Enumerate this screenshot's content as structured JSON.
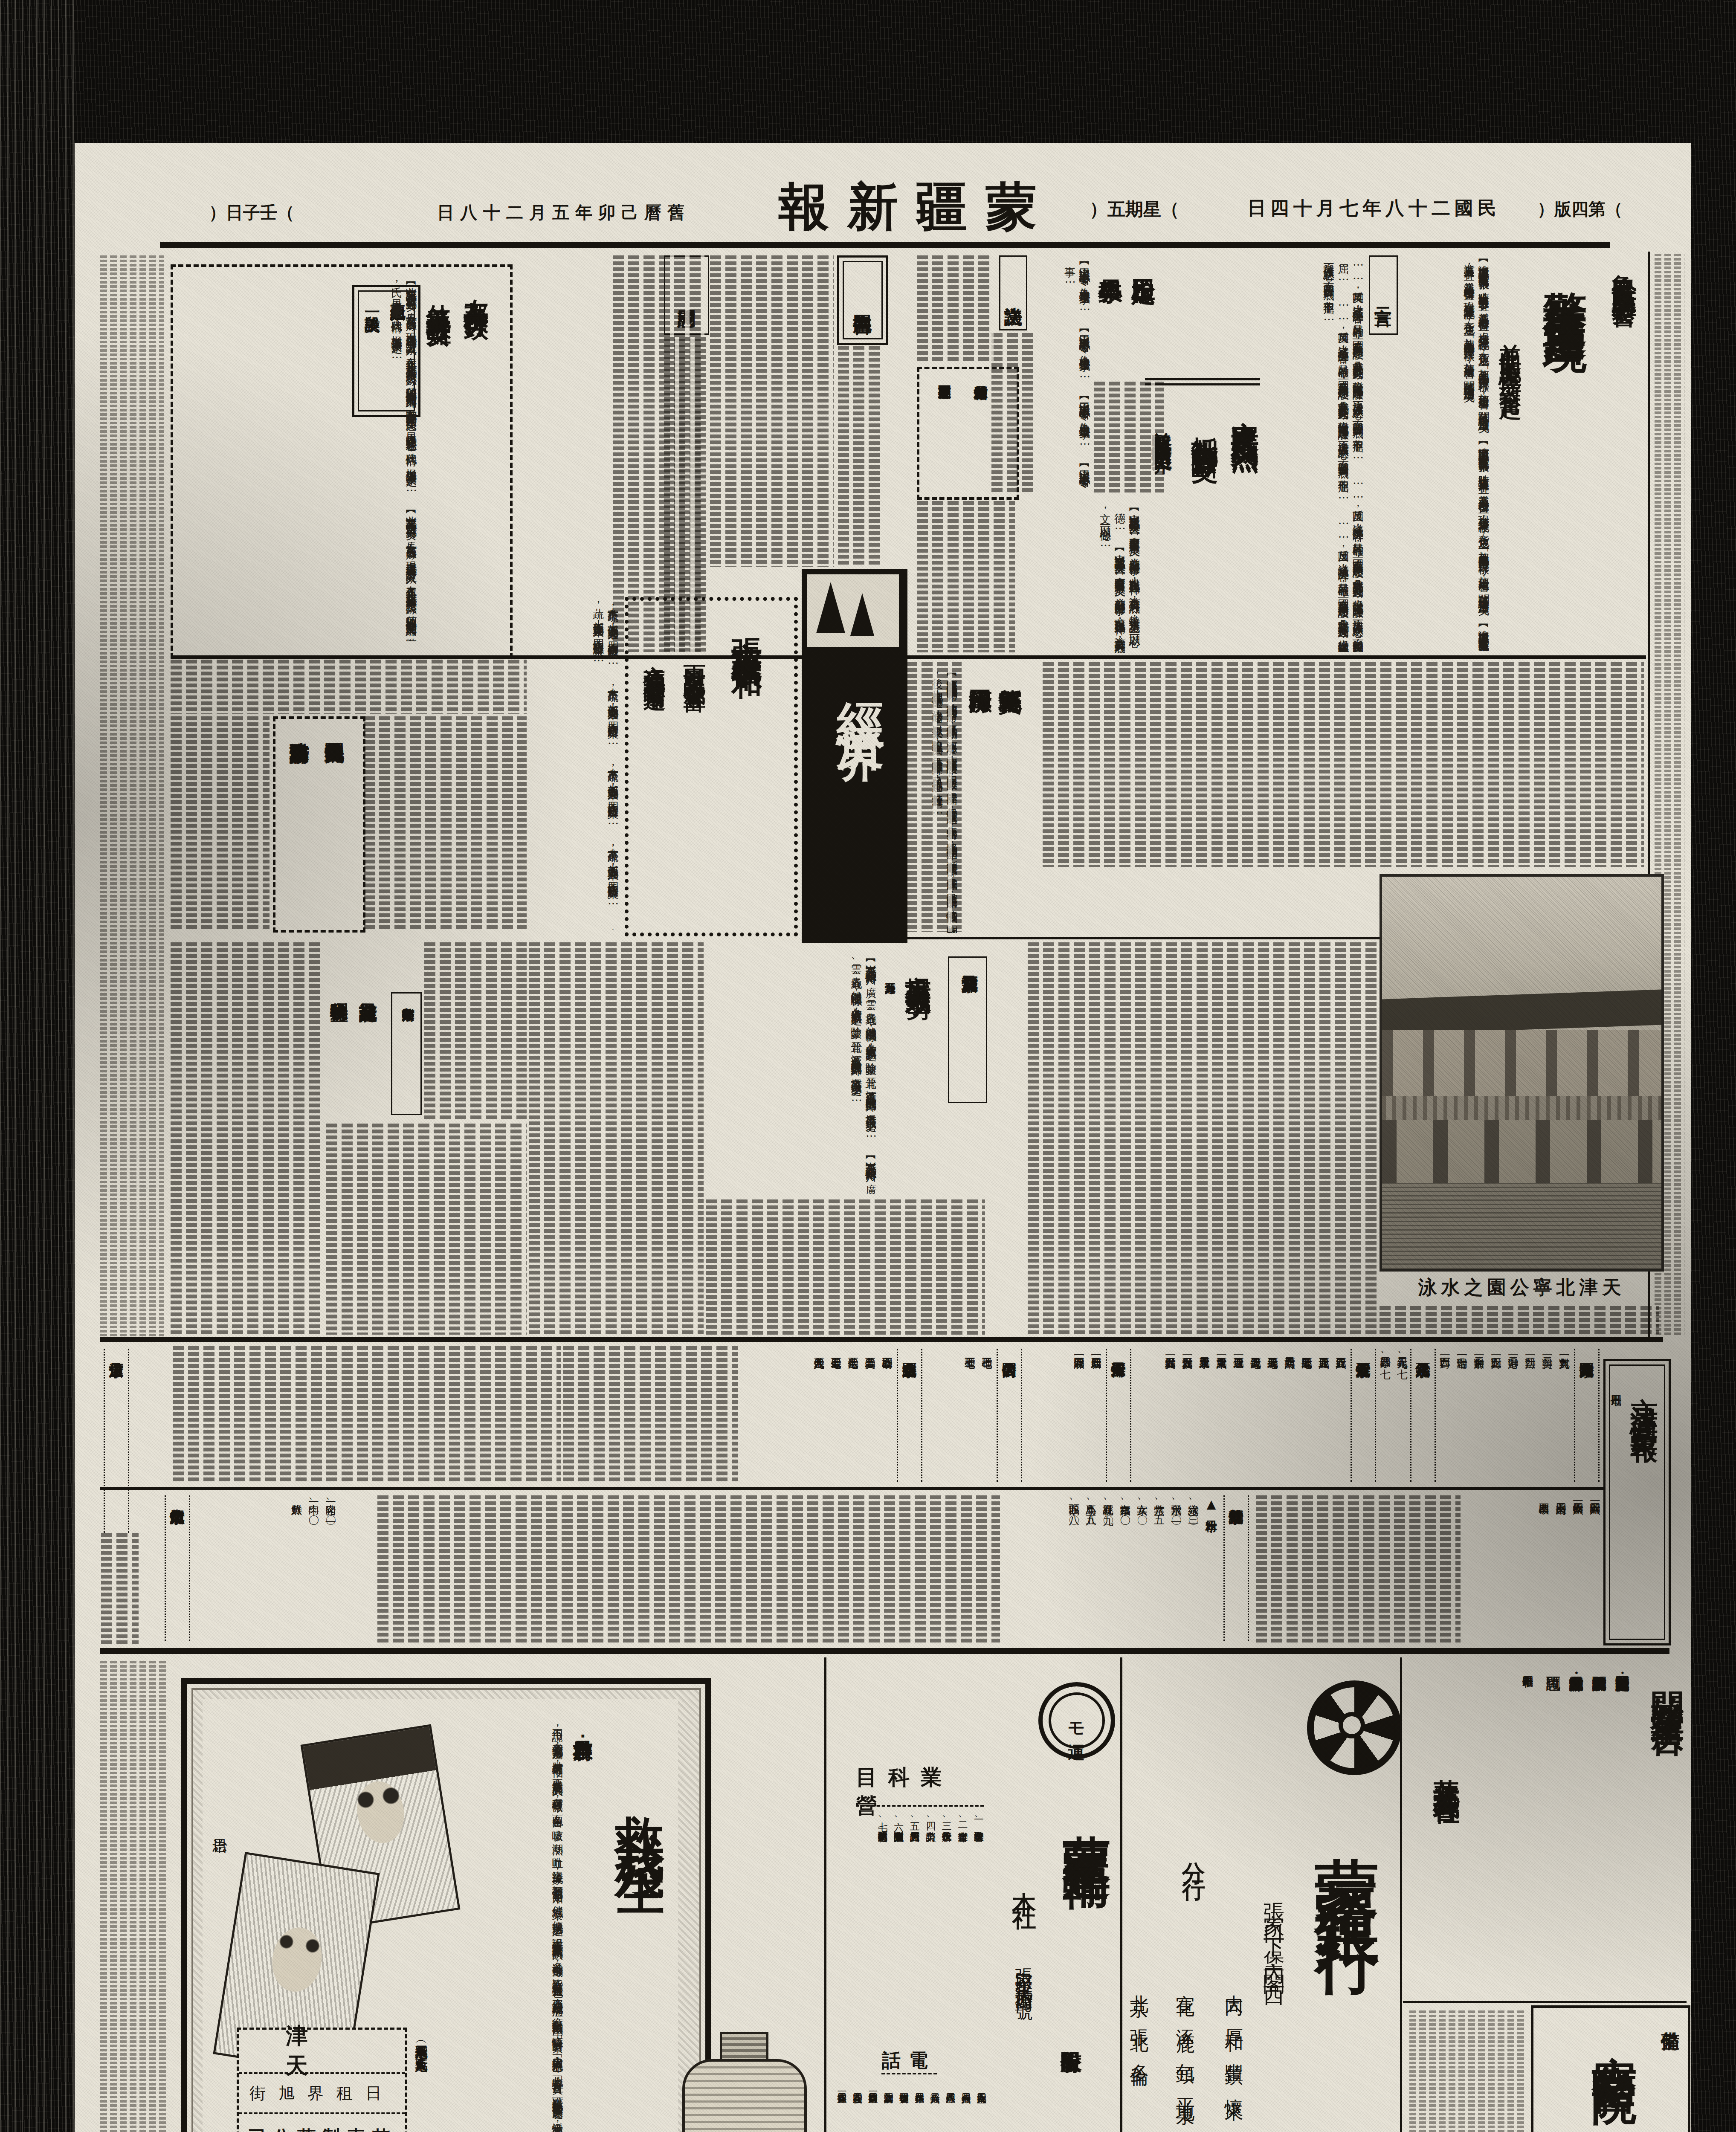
{
  "masthead": {
    "title": "\u8499\u7586\u65b0\u5831",
    "edition": "\uff08\u7b2c\u56db\u7248\uff09",
    "date_line": "\u6c11\u570b\u4e8c\u5341\u516b\u5e74\u4e03\u6708\u5341\u56db\u65e5",
    "weekday": "\uff08\u661f\u671f\u4e94\uff09",
    "lunar_date": "\u820a\u66c6\u5df1\u536f\u5e74\u4e94\u6708\u4e8c\u5341\u516b\u65e5",
    "cyclical_day": "\uff08\u58ec\u5b50\u65e5\uff09"
  },
  "articles": {
    "lead": {
      "kicker": "\u9b6f\u5168\u6c11\u53cd\u82f1\u9632\u5171\u59d4\u6703",
      "headline": "\u8b66\u544a\u82f1\u50d1\u8fc5\u901f\u51fa\u5883",
      "subhead": "\u4e26\u4fc3\u540c\u80de\u89ba\u609f\u4e00\u81f4\u596e\u8d77",
      "excerpt": "\u3010\u6fdf\u5357\u901a\u8a0a\u3011\u6fdf\u5168\u5e02\u6c11\u773e\u53cd\u82f1\u7a7a\u6c23\u7570\u5e38\u7dca\u5f35\uff0c\u6642\u8ad6\u4fc3\u9032\u53cd\u82f1\u529b\u91cf\u4e8b\u5b9c\uff0c\u4e26\u6d3e\u54e1\u5206\u5341\u7d44\u51fa\u767c\u5ba3\u50b3\uff0c\u73fe\u5728\u82f1\u8ca8\u7d93\u767b\u8a18\u5f8c\uff0c\u5728\u8ca8\u4e4b\u5305\u76ae\u4e0a\uff0c\u52a0\u84cb\u300c\u51e1\u7cfb\u4e2d\u570b\u4eba\u4e0d\u8cb7\u82f1\u8ca8\u300d\u5b57\u6a23\uff0c\u52a0\u84cb\u5f8c\u59cb\u51c6\u51fa\u552e\uff0c\u805e\u82f1\u50d1\u5df2\u7d1b\u7d1b\u6e96\u5099\u8fc5\u901f\u51fa\u5883\u77e3\u3002"
    },
    "declaration": {
      "label": "\u5ba3\u8a00\u4e8c",
      "excerpt": "\u2026\u2026\u53cd\u82f1\u570b\uff0c\u9042\u7d50\u6210\u4e86\u53cd\u82f1\u9663\u5bb9\uff0c\u5176\u76ee\u7684\u78ba\u7acb\uff0c\u570b\u5bb6\u6771\u4e9e\u65b0\u79e9\u5e8f\u7684\u5efa\u8a2d\uff0c\u51e1\u6211\u6771\u4e9e\u6c11\u773e\u53cd\u82f1\u904b\u52d5\uff0c\u8a93\u4ee5\u64b2\u6ec5\u82f1\u570b\u4e4b\u9670\u8b00\uff0c\u6c7a\u8207\u82f1\u50d1\u4e00\u81f4\u4e4b\u6c7a\u5fc3\uff0c\u800c\u8207\u82f1\u570b\u596e\u9b25\u5230\u5e95\uff0c\u975e\u4f46\u4e0d\u5c48\u2026\u2026"
    },
    "anci": {
      "h1": "\u5b89\u6b21\u6c11\u773e\u53cd\u82f1\u71b1\u70c8",
      "h2": "\u62b5\u5236\u4ec7\u8ca8\u5be6\u884c\u65b7\u4ea4",
      "h3": "\u4e26\u5805\u6c7a\u8981\u6c42\u6536\u56de\u82f1\u79df\u754c",
      "excerpt": "\u3010\u5b89\u6b21\u901a\u8a0a\u3011\u672c\u7e23\u8208\u4e9e\u53cd\u82f1\u5927\u6703\uff0c\u6703\u5206\u5340\u53ec\u96c6\u6c11\u773e\u4e00\u81f4\u53cd\u82f1\uff0c\u4e26\u5206\u5225\u8209\u8fa6\u9031\u9593\u884c\u4e8b\uff0c\u85c9\u4ee5\u8868\u73fe\u8208\u4e9e\u7cbe\u795e\uff0c\u8a72\u6703\u70ba\u53cd\u82f1\u5230\u5e95\u8a08\uff0c\u7279\u767c\u8868\u5927\u6703\u6c7a\u8b70\u6587\uff0c\u4ee5\u671f\u4e00\u5fc3\u4e00\u5fb7\u2026\u2026"
    },
    "yutian": {
      "h1": "\u7389\u7530\u6aa2\u5b9a",
      "h2": "\u5c0f\u5b78\u6559\u54e1",
      "excerpt": "\u3010\u7389\u7530\u901a\u8a0a\u3011\u672c\u7e23\u516c\u7f72\u4ee4\uff0c\u70ba\u6aa2\u5b9a\u5c0f\u5b78\u6559\u54e1\u4e8b\u2026\u2026"
    },
    "resolution": {
      "label": "\u6c7a\u8b70\u6587"
    },
    "tu": {
      "h1": "\u6d82\u7e23\u9577\u7b49\u76f8\u5055\u8d74\u6d25",
      "h2": "\u6170\u554f\u7687\u8ecd\u4e26\u8072\u63f4\u53cd\u82f1"
    },
    "letter": {
      "label": "\u544a\u540c\u80de\u66f8"
    },
    "condolence": {
      "label": "\u6170\u554f\u8a5e"
    },
    "friendly": {
      "h1": "\u53cb\u90a6\u4eba\u58eb\u4fe0\u884c\u53ef\u6b3d",
      "h2": "\u4ed7\u7fa9\u633a\u8eab\u6551\u51fa\u96e3\u5973",
      "k1": "\u8208\u4e9e\u7d00\u5ff5\u4e2d",
      "k2": "\u4e00\u6bb5\u7f8e\u8ac7",
      "excerpt": "\u3010\u5317\u4eac\u8a0a\u3011\u5143\u8005\u5e74\u903e\u516d\u5341\u4e00\u6b72\u884c\u4e8c\u7537\u4e09\u5973\uff0c\u9577\u5973\u6b21\u5973\u5404\u5df2\u51fa\u5ac1\uff0c\u73fe\u5728\u8001\u592b\u5a66\u8207\u4e8c\u7537\u4e8c\u5973\u8a08\u4e00\u5bb6\u4e94\u4eba\uff0c\u5728\u672c\u5e74\u4e8c\u6708\u5341\u516b\u65e5\u5317\u5973\u6200\u8c9e\uff08\u5e74\u5341\u516b\uff09\u5ffd\u7136\u5931\u8e2a\uff0c\u5075\u9a0e\u56db\u51fa\u641c\u7d22\u4ea6\u4e0d\u80fd\u77e5\u5176\u7e61\uff0c\u6642\u6709\u9130\u5bb6\u4e2d\u548c\u6d0b\u884c\u5c71\u672c\u82f1\u61b2\u6c0f\uff0c\u65e5\u591c\u76ee\u7779\u8001\u592b\u5a66\u4e4b\u60b2\u50b7\uff0c\u6b8a\u4ee3\u540c\u60c5\uff0c\u6975\u529b\u8207\u83ef\u4eba\u4f5c\u641c\u7d22\u4e4b\u2026\u2026"
    },
    "baodi": {
      "h1": "\u5bf6\u577b\u7e23\u4fee\u7bc9",
      "h2": "\u7bad\u687f\u6cb3\u96aa\u5de5",
      "excerpt": "\u3010\u5bf6\u577b\u901a\u8a0a\u3011\u672c\u7e23\u7b2c\u4e94\u5340\u5f35\u982d\u7aa9\u4e00\u5e36\uff0c\u5730\u52e2\u7aaa\u4e0b\u70ba\u7bad\u687f\u6cb3\u4e0b\u6e38\uff0c\u6bcf\u81f3\u4f0f\u6c5b\u6642\u671f\uff0c\u6cb3\u6c34\u6f32\u767c\uff0c\u5169\u5cb8\u5824\u57dd\u96d6\u7d93\u9632\u8b77\uff0c\u4f46\u56e0\u571f\u8cea\u9b06\u6563\uff0c\u5824\u5cb8\u4e0d\u56fa\uff0c\u4ecd\u7279\u6709\u6cdb\u6feb\u4e4b\u60a3\uff0c\u53bb\u5e74\u6c34\u52e2\u6eab\u731b\uff0c\u5c07\u5824\u57dd\u6c96\u5237\u6b86\u76e1\uff0c\u7e23\u4e4b\u6771\u5357\u5169\u90e8\uff0c\u76e1\u6210\u6fa4\u570b\uff0c\u9109\u6c11\u6d41\u96e2\u5931\u6240\uff0c\u60c5\u6975\u53ef\u61ab\uff0c\u5289\u77e5\u4e8b\u5230\u4efb\u5f8c\uff0c\u62b1\u5b9a\u5df1\u98e2\u5df1\u6eba\u4e4b\u61f7\uff0c\u6c7a\u5fc3\u4fee\u5835\uff0c\u4ee5\u62ef\u707d\u9ece\uff0c\u9664\u4ee5\u5de5\u7a0b\u6d69\u5927\uff0c\u5448\u8acb\u4e0a\u5cf0\u64a5\u6b3e\u4fee\u7bc9\u5916\uff0c\u53c8\u4ee5\u4f0f\u6c5b\u671f\u8fd1\uff0c\u7279\u65bc\u4e94\u6708\u9593\u2026\u2026"
    },
    "economy": {
      "box_title": "\u7d93\u6fdf\u754c"
    },
    "zhang": {
      "h1": "\u5f35\u5e02\u83dc\u852c\u552e\u50f9\u5e73\u548c",
      "s1": "\u96e8\u91cf\u5145\u8db3\u6536\u6210\u8c50\u5bcc",
      "s2": "\u4ea4\u901a\u4fbf\u5229\u4eac\u8ca8\u66a2\u904b",
      "excerpt": "\u672c\u5e02\u83dc\u852c\uff0c\u5927\u90e8\u4fc2\u7531\u5317\u4eac\u904b\u4f86\uff0c\u56db\u5b63\u5747\u6709\u61c9\u6642\u9bae\u83dc\u2026\u2026"
    },
    "tax": {
      "h1": "\u570b\u7a05\u4e26\u7121\u514d\u8cbb\u5148\u4f8b",
      "h2": "\u4eac\u8ca1\u653f\u90e8\u54a8\u8acb\u67e5\u8fa6"
    },
    "misc": {
      "label": "\u5317\u4eac\u96dc\u8ca8\u50f9\u53c8\u6f32",
      "headline": "\u5e02\u5834\u5448\u4f9b\u4e0d\u6577\u6c42\u52e2",
      "note": "\u9ec3\u8449\u6bcf\u65a4\u6f32\u9054\u4e94\u89d2",
      "excerpt": "\u3010\u4eac\u8a0a\u3011\u5317\u4eac\u96dc\u8ca8\u4f86\u6e90\u5411\u6043\u5ddd\u3001\u5ee3\u3001\u96f2\u3001\u8cb4\u5404\u5730\uff0c\u7136\u4ee5\u904b\u8f38\u95dc\u4fc2\uff0c\u5404\u8655\u8ca8\u6e90\u6f38\u611f\u7f3a\u4e4f\uff0c\u9664\u8499\u7586\u3001\u6649\u5317\u3001\u6c5f\u8607\u5404\u8655\u51fa\u54c1\u5c1a\u80fd\u5927\u6279\u4f9b\u7d66\u5916\uff0c\u5e02\u5834\u5448\u4f9b\u4e0d\u6577\u6c42\u4e4b\u52e2\u2026\u2026"
    },
    "commerce": {
      "label": "\u4eac\u6d25\u5546\u8c61\u7e41\u69ae",
      "h1": "\u5546\u696d\u767b\u8a18\u8a3b\u518a",
      "h2": "\u7a05\u6536\u7279\u5225\u76db\u65fa"
    },
    "photo": {
      "caption": "\u5929\u6d25\u5317\u5be7\u516c\u5712\u4e4b\u6c34\u6cf3"
    }
  },
  "market": {
    "box_title": "\u4eac\u6d25\u5546\u60c5\u5f59\u5831",
    "date_note": "\u4e03\u6708\u5341\u56db\u65e5",
    "fx": {
      "title": "\u4eac\u6d25\u5916\u570b\u532f\u514c",
      "entries": [
        {
          "n": "\u5c0d\u82f1",
          "v": "\u4e00\u4e00\u4e5d\u516d"
        },
        {
          "n": "\u5c0d\u7f8e",
          "v": "\u4e8c\u3007\u4e00"
        },
        {
          "n": "\u5c0d\u6cd5",
          "v": "\u4e09\u3007\u4e00"
        },
        {
          "n": "\u5c0d\u6e2f",
          "v": "\u4e8c\u3007\u4e00\u3007"
        },
        {
          "n": "\u5c0d\u6bd4",
          "v": "\u4e00\u3007\u4e94"
        },
        {
          "n": "\u5c0d\u52a0\u62ff\u5927",
          "v": "\u4e8c\u4e00\u3007"
        },
        {
          "n": "\u5c0d\u745e\u58eb",
          "v": "\u4e00\u3007\u4e00"
        },
        {
          "n": "\u5c0d\u5df4\u897f",
          "v": "\u4e09\u4e09\u4e00"
        }
      ]
    },
    "silver": {
      "title": "\u5317\u4eac\u9280\u5143\u9214\u7968",
      "entries": [
        {
          "n": "\u9280\u5143",
          "v": "\u4e8c\u4e09\u4e5d\u3001\u4e03"
        },
        {
          "n": "\u9214\u7968",
          "v": "\u4e8c\u4e09\u56db\u3001\u4e03"
        }
      ]
    },
    "bj_stocks": {
      "title": "\u5317\u4eac\u80a1\u7968\u884c\u60c5",
      "entries": [
        {
          "n": "\u884c\u80a1\u7968",
          "v": "\u4e94\u516d\u5143"
        },
        {
          "n": "\u57ce\u80a1\u7968",
          "v": "\u4e94\u516d\u5143"
        },
        {
          "n": "\u9678\u80a1\u7968",
          "v": "\u4e94\u4e03\u5143"
        },
        {
          "n": "\u5357\u80a1\u7968",
          "v": "\u516d\u4e8c\u5143"
        },
        {
          "n": "\u7d72\u80a1\u7968",
          "v": "\u4e94\u4e03\u5143"
        },
        {
          "n": "\u9435\u80a1\u7968",
          "v": "\u4e03\u4e5d\u5143"
        },
        {
          "n": "\u71c8\u80a1\u7968",
          "v": "\u4e00\u4e94\u5143"
        },
        {
          "n": "\u6771\u80a1\u7968",
          "v": "\u516d\u4e00\u5143"
        },
        {
          "n": "\u4f86\u6c34\u80a1\u7968",
          "v": "\u4e8c\u4e94\u5143"
        },
        {
          "n": "\u6f22\u652f\u4ed8\u5238",
          "v": "\u4e00\u3007\u4e94\u5143"
        },
        {
          "n": "\u7dde\u652f\u4ed8\u5238",
          "v": "\u4e00\u3007\u3007\u4e94\u5143"
        }
      ]
    },
    "tj_stocks": {
      "title": "\u5929\u6d25\u80a1\u7968\u884c\u60c5",
      "entries": [
        {
          "n": "\u555f\u65b0\u80a1\u7968",
          "v": "\u4e00\u4e00\u3007\u5143"
        },
        {
          "n": "\u958b\u7064\u80a1\u7968",
          "v": "\u4e00\u4e09\u4e00\u5143"
        }
      ]
    },
    "bonds": {
      "title": "\u4e2d\u570b\u570b\u5167\u516c\u50b5",
      "entries": [
        {
          "n": "\u4e59\u7a2e",
          "v": "\u4e03\u4e09\u3007"
        },
        {
          "n": "\u4e01\u7a2e",
          "v": "\u4e03\u4e94\u3007"
        }
      ]
    },
    "gold_notes": {
      "title": "\u5317\u4eac\u5404\u570b\u91d1\u7968",
      "entries": [
        {
          "n": "\u91d1\u78c5",
          "v": "\u56db\u4e94\u4e94\u3007"
        },
        {
          "n": "\u7f8e\u91d1\u7968",
          "v": "\u4e94\u3007\u3007"
        },
        {
          "n": "\u6cd5\u91d1\u7968",
          "v": "\u4e03\u4e09\u3007"
        },
        {
          "n": "\u65e5\u91d1\u7968",
          "v": "\u4e03\u4e94\u3007"
        },
        {
          "n": "\u4fc4\u91d1\u7968",
          "v": "\u516d\u4e5d\u516d\u3007"
        }
      ]
    },
    "gold_price": {
      "title": "\u4eac\u6d25\u8db3\u91d1\u5e02\u50f9"
    },
    "flour": {
      "title": "\u5317\u4eac\u9eb5\u7c89\u884c\u60c5",
      "subtitle": "\u25b2\u65e5\u672c\u7c89",
      "entries": [
        {
          "n": "\u7da0\u5b57",
          "v": "\u516d\u3001\u4e09\u3007"
        },
        {
          "n": "\u98db\u5b57",
          "v": "\u516d\u3001\u4e8c\u3007"
        },
        {
          "n": "\u7af9\u5b57",
          "v": "\u516d\u3001\u4e00\u4e94"
        },
        {
          "n": "\u5973\u5b57",
          "v": "\u516d\u3001\u4e00\u3007"
        },
        {
          "n": "\u767d\u798f\u5b57",
          "v": "\u516d\u3001\u3007\u3007"
        },
        {
          "n": "\u7d05\u6843\u82b1",
          "v": "\u4e94\u3001\u4e5d\u3007"
        },
        {
          "n": "\u5c0f\u9ce5",
          "v": "\u4e94\u3001\u516b\u4e94"
        },
        {
          "n": "\u9d5d\u982d",
          "v": "\u4e94\u3001\u516b\u3007"
        }
      ]
    },
    "bullion": {
      "entries": [
        {
          "n": "\u958b\u76e4",
          "v": "\u4e8c\u5169\u4e00\u4e09\u516d"
        },
        {
          "n": "\u6536\u76e4",
          "v": "\u4e8c\u5169\u4e00\u56db\u516d"
        },
        {
          "n": "\u51fa\u4f86\u9ad8",
          "v": "\u4e8c\u56db\u5169\u3007\u4e8c"
        },
        {
          "n": "\u7834\u7968",
          "v": "\u56db\u5169\u4e09"
        }
      ]
    },
    "fish": {
      "title": "\u5317\u4eac\u9b5a\u8089\u884c\u60c5",
      "entries": [
        {
          "n": "\u8c6c\u8089",
          "v": "\u4e00\u3001\u4e8c\u3007"
        },
        {
          "n": "\u725b\u8089",
          "v": "\u4e00\u3001\u3007\u3007"
        },
        {
          "n": "\u9bae\u9b5a",
          "v": "\u516b\u3007"
        }
      ]
    }
  },
  "ads": {
    "transport": {
      "title": "\u958b\u59cb\u71df\u696d\u5ee3\u544a",
      "b1": "\u8332\u81ea\u4e03\u6708\u4e09\u65e5\u8d77\u958b\u59cb\u96b4\u6d77\u8def\u963f\u6e56\u30fb\u65b0\u5b89\u9593\u4e4b\u65c5\u5ba2",
      "b2": "\u884c\u674e\u5305\u88f9\u53ca\u8ca8\u7269\u904b\u9001\u71df\u696d\u95dc\u65bc\u8a73\u7d30\u8acb\u5411\u672c\u793e",
      "b3": "\u90e8\u65c5\u5ba2\u8ab2\u30fb\u8ca8\u7269\u8ab2\u30fb\u6700\u8fd1\u9435\u8def\u5c40\u71df\u696d\u8655\u6216\u6700\u8fd1\u7ad9",
      "b4": "\u8a0a\u554f\u53ef\u4e5f",
      "date": "\u662d\u548c\u5341\u56db\u5e74\u4e03\u6708\u5341\u65e5",
      "signature": "\u83ef\u5317\u4ea4\u901a\u682a\u5f0f\u6703\u793e"
    },
    "hospital": {
      "note1": "\u6574\u5099",
      "note2": "\u5404\u79d1",
      "name": "\u5bdf\u5357\u91ab\u9662",
      "address": "\u5bdf\u5357\u81ea\u6cbb\u653f\u5e9c\u5317\u90ca"
    },
    "bank": {
      "name": "\u8499\u7586\u9280\u884c",
      "head_office": "\u5f35\u5bb6\u53e3\u4e0b\u5821\u5167\u95a3\u897f",
      "branch_label": "\u5206\u884c",
      "br1": "\u5927\u540c \u539a\u548c \u8c50\u93ae \u61f7\u4f86",
      "br2": "\u5ba3\u5316 \u6dbf\u9e7f \u5305\u982d \u5e73\u5730\u6cc9",
      "br3": "\u5317\u4eac \u5f35\u5317 \u591a\u502b"
    },
    "shipping": {
      "logo_text": "\u30e2\u904b",
      "name_main": "\u8499\u7586\u904b\u8f38",
      "name_mid": "\u80a1\u4efd\u6709\u9650",
      "name_tail": "\u516c\u53f8",
      "office_label": "\u672c\u793e",
      "office_address": "\u5f35\u5bb6\u53e3\u5ba3\u5316\u5927\u9053\u8857\u56db\u4e00\u865f",
      "cable": "\u96fb\u7565\u30de\u30eb",
      "business_header": "\u71df\u696d\u79d1\u76ee",
      "items": [
        "\u4e00\u3001\u904b\u9001\u53ca\u904b\u9001\u53d6\u6271\u71df\u696d",
        "\u4e8c\u3001\u5009\u5eab\u71df\u696d",
        "\u4e09\u3001\u4ee3\u8fa6\u53ca\u4fdd\u7ba1\u884c\u674e",
        "\u56db\u3001\u52de\u529b\u8acb\u8ca0",
        "\u4e94\u3001\u9700\u54c1\u8a17\u529b\u4fdd\u7ba1\u8cc7\u8cb7",
        "\u516d\u3001\u91d1\u878d\u901a\u878d\u76f4\u63a5\u904b\u9001\u95dc\u4fc2\u8ca8\u7269\u8cc7\u8cb7\u8ce3",
        "\u4e03\u3001\u9644\u5c6c\u524d\u9805\u4e4b\u4e00\u5207\u696d\u52d9"
      ],
      "phone_header": "\u96fb\u8a71",
      "phones": [
        {
          "n": "\u652f\u914d\u4eba\u5ba4",
          "v": "\u4e8c\u4e5d\u56db\u3007"
        },
        {
          "n": "\u5eb6\u52d9\u4fc2",
          "v": "\u4e8c\u516b\u516d\u56db"
        },
        {
          "n": "\u7d93\u7406\u4fc2",
          "v": "\u4e8c\u516b\u516b\u56db"
        },
        {
          "n": "\u904b\u8f38\u4fc2",
          "v": "\u4e8c\u516b\u516d\u516b"
        },
        {
          "n": "\u696d\u52d9\u4fc2",
          "v": "\u4e8c\u516b\u56db\u56db"
        },
        {
          "n": "\u767c\u8457\u8ca8\u7269\u4fc2",
          "v": "\u4e09\u4e09\u56db\u56db"
        },
        {
          "n": "\u5230\u8457\u8ca8\u7269\u6240",
          "v": "\u4e09\u4e09\u4e09\u516b"
        },
        {
          "n": "\u8857\u9593\u6271\u4e58\u76f4",
          "v": "\u4e8c\u516b\u56db\u4e00"
        },
        {
          "n": "\u591c\u9593\u5bbf\u76f4",
          "v": "\u4e8c\u516b\u56db\u3007"
        },
        {
          "n": "\u7576\u76f4\u642c\u904b\u4fc2",
          "v": "\u4e00\u4e8c\u516b\u56db"
        }
      ]
    },
    "medicine": {
      "title": "\u6551\u6211\u6b98\u751f",
      "kicker": "\u80ba\u7646\u6551\u661f\uff1a",
      "excerpt": "\u4e0d\u7528\u8aaa\uff0c\u6211\u5011\u5927\u5bb6\u90fd\u77e5\u9053\uff0c\u80ba\u75c5\u662f\u4f55\u7b49\u53ef\u6015\uff0c\u8981\u77e5\u9053\u60a3\u80ba\u7646\u7684\u4eba\uff0c\u6709\u7a2e\u7a2e\u5fb5\u5fae\uff0c\u9762\u8272\u84bc\u767d\uff0c\u54b3\u55fd\uff0c\u6f6e\u71b1\uff0c\u5410\u8840\uff0c\u76dc\u6c57\u7b49\u73fe\u8c61\uff0c\u6211\u5011\u4fbf\u53ef\u4e00\u671b\u800c\u77e5\u3002\u5018\u7d93\u611f\u67d3\uff0c\u4fbf\u6210\u96e3\u6cbb\u4e4b\u75c7\uff0c\u8a2d\u73fe\u5728\u6d41\u884c\u4e4b\u85e5\u54c1\u53ca\u4eba\u5de5\u6c23\u80f8\u6cd5\uff0c\u591a\u906e\u88dc\u871c\u5291\u7b49\uff0c\u7686\u4e0d\u80fd\u6709\u986f\u8457\u4e4b\u529f\u6548\u4e5f\u3002\u5018\u8981\u60f3\u6cbb\u6b64\u7a2e\u75c5\u75c7\uff0c\u9808\u6709\u5c0d\u75c7\u7684\u6bba\u83cc\u5291\uff0c\u6070\u5de7\u91ab\u963f\u300c\u82e5\u7d20\u300d\uff0c\u5167\u542b\u5927\u91cf\u300c\u7dad\u4ed6\u547d\u4e59\u300d\uff0c\u6b64\u4e2d\u4e26\u542b\u6709\u300c\u5bcc\u62c9\u8cd3\u300d\uff0c\u51c6\u53ef\u6bba\u6ec5\u6b64\u80ba\u4e2d\u5766\u4e16\u754c\u5049\u5927\u4e4b\u767c\u660e\u2014\u6d3b\u6027\u9ed1\u9ef4\u83cc\uff0c\u53ef\u589e\u6b96\u767d\u8840\u7403\uff0c\u5e38\u98df\u83cc\u529b\uff0c\u4f55\u6cc1\u53c8\u542b\u5404\u7a2e\u71df\u990a\u54c1\uff0c\u670d\u5f8c\u4fbf\u53ef\u898b\u6548\uff01",
      "maker1": "\u5929\u6d25",
      "maker2": "\u65e5\u79df\u754c\u65ed\u8857",
      "maker3": "\u82e5\u7d20\u88fd\u85e5\u516c\u53f8",
      "price": "\u50f9\u76ee\uff08\u516b\u5341\u56db\u7247\u5c0f\u74f6\u4e94\u6bdb\u3000\u4e09\u767e\u7247\u5927\u74f6\u4e00\u5143\u516d\u6bdb\uff09",
      "brand": "\u82e5\u7d20",
      "slogan1": "\u53bb\u75c5\u5ef6\u5e74",
      "slogan2": "\u5f37\u8eab\u88dc\u8840",
      "signature": "\u601d\u8bd2"
    }
  }
}
